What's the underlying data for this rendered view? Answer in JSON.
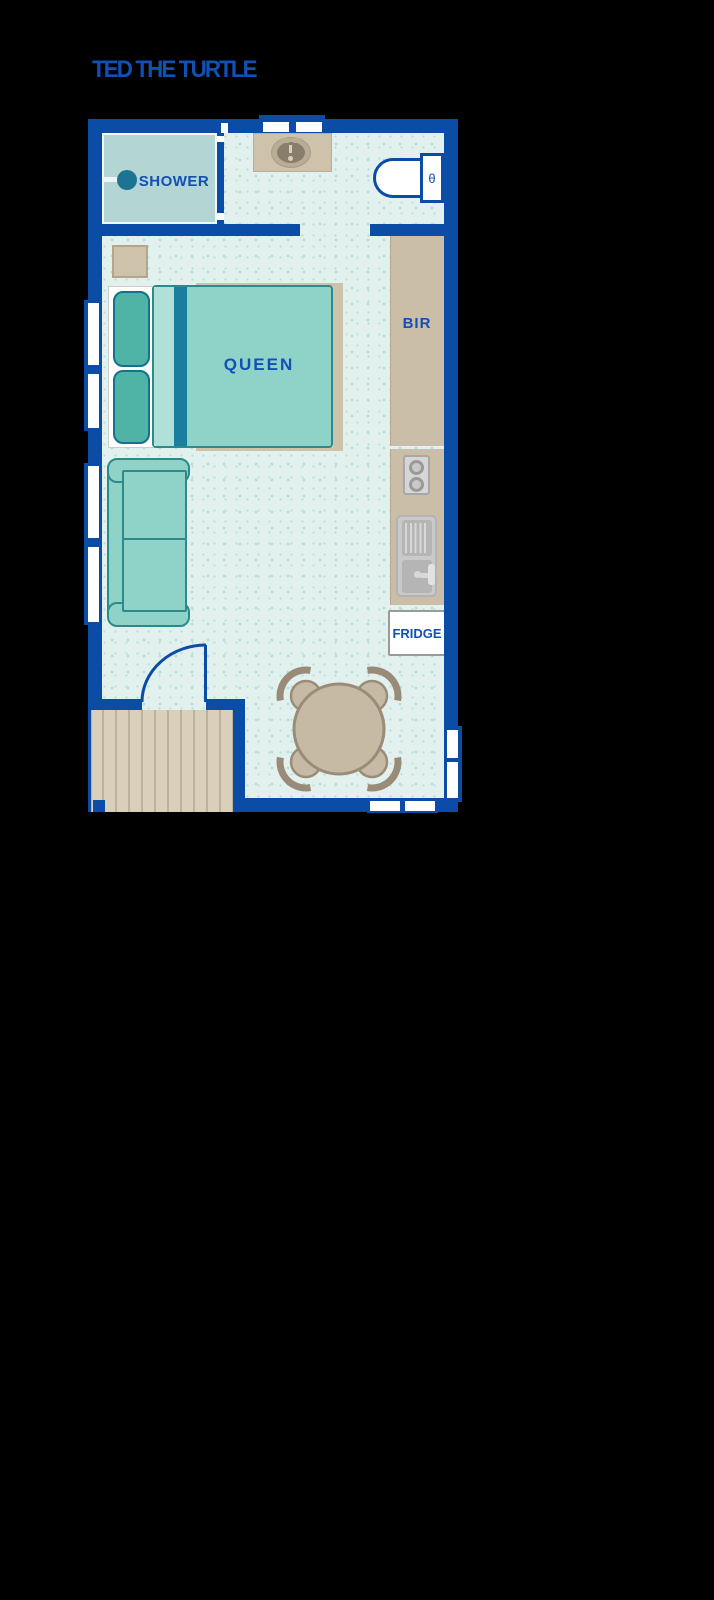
{
  "canvas": {
    "width": 714,
    "height": 1600,
    "background": "#000000"
  },
  "title": {
    "text": "TED THE TURTLE"
  },
  "plan": {
    "colors": {
      "page": "#000000",
      "wall": "#0b4da6",
      "label_blue": "#1150b4",
      "floor": "#e2f1ee",
      "floor_dot": "#b6ded8",
      "shower_fill": "#b3d5d3",
      "shower_head": "#1c7492",
      "furniture_teal": "#8fd2c8",
      "furniture_teal_dark": "#2d8a8a",
      "pillow_teal": "#4fb3a6",
      "blanket_stripe": "#1a7f9e",
      "blanket_fold": "#b0e0d8",
      "timber": "#cfc2aa",
      "timber_dark": "#b3a68c",
      "bench_tan": "#cbbea8",
      "sink_rim": "#b9ad97",
      "sink_bowl": "#897e6c",
      "deck": "#dacfbb",
      "deck_plank": "#bfb29c",
      "table_tan": "#c7baa5",
      "table_edge": "#998c79",
      "appliance_light": "#d6d6d6",
      "appliance_mid": "#b5b5b5",
      "appliance_dark": "#9a9a9a"
    },
    "labels": {
      "shower": "SHOWER",
      "bed": "QUEEN",
      "robe": "BIR",
      "fridge": "FRIDGE",
      "toilet_button": "θ"
    }
  }
}
